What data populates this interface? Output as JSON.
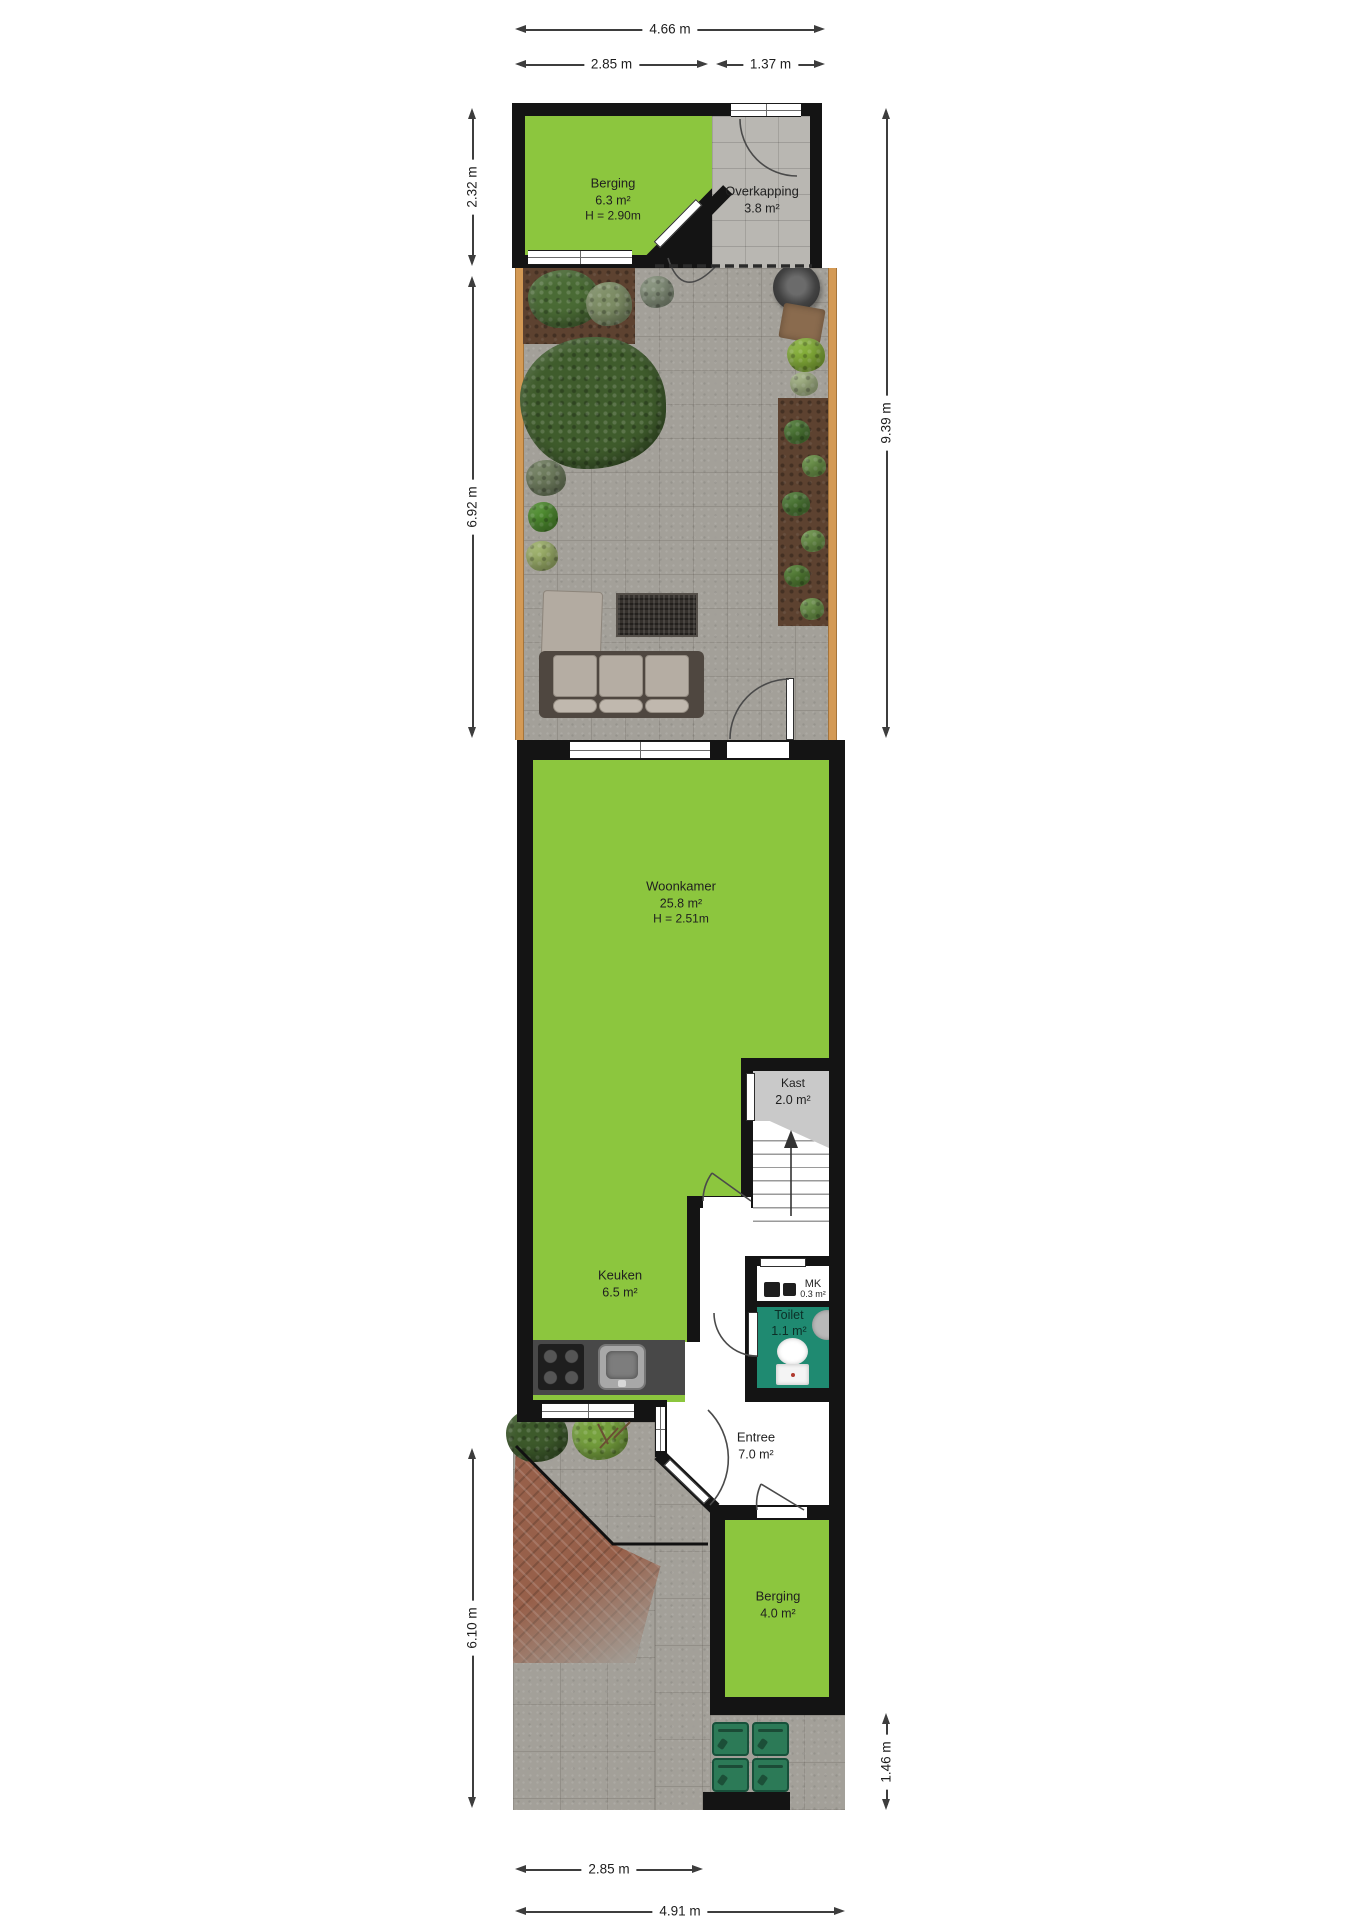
{
  "plan": {
    "dimensions": {
      "top_total": "4.66 m",
      "top_left": "2.85 m",
      "top_right": "1.37 m",
      "left_upper": "2.32 m",
      "left_middle": "6.92 m",
      "left_lower": "6.10 m",
      "right_upper": "9.39 m",
      "right_lower": "1.46 m",
      "bottom_inner": "2.85 m",
      "bottom_total": "4.91 m"
    },
    "rooms": {
      "berging_top": {
        "name": "Berging",
        "area": "6.3 m²",
        "height": "H = 2.90m"
      },
      "overkapping": {
        "name": "Overkapping",
        "area": "3.8 m²"
      },
      "woonkamer": {
        "name": "Woonkamer",
        "area": "25.8 m²",
        "height": "H = 2.51m"
      },
      "kast": {
        "name": "Kast",
        "area": "2.0 m²"
      },
      "keuken": {
        "name": "Keuken",
        "area": "6.5 m²"
      },
      "meterkast": {
        "name": "MK",
        "area": "0.3 m²"
      },
      "toilet": {
        "name": "Toilet",
        "area": "1.1 m²"
      },
      "entree": {
        "name": "Entree",
        "area": "7.0 m²"
      },
      "berging_bottom": {
        "name": "Berging",
        "area": "4.0 m²"
      }
    },
    "colors": {
      "room_green": "#8cc63e",
      "wall_black": "#141414",
      "toilet_teal": "#1f8a71",
      "paving_grey": "#a3a099",
      "overkapping_grey": "#b9b7b2",
      "fence_wood": "#d49a55",
      "soil_brown": "#5d4230",
      "brick_red": "#97604a",
      "bin_green": "#2c7a57"
    }
  }
}
